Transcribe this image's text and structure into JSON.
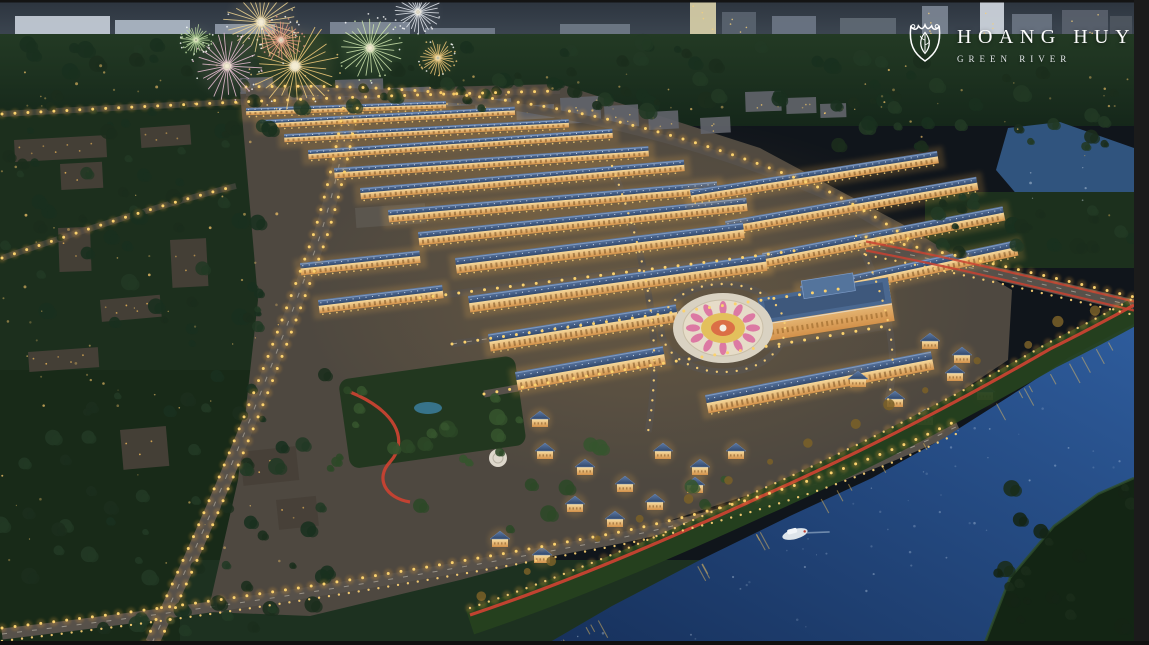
{
  "image": {
    "kind": "aerial-night-rendering",
    "subject": "riverside residential masterplan with fireworks"
  },
  "brand": {
    "name": "HOANG HUY",
    "subtitle": "GREEN RIVER",
    "icon": "shield-leaf-crest-icon",
    "text_color": "#ffffff"
  },
  "palette": {
    "sky": "#39434f",
    "sky_top": "#2c343e",
    "forest_dark": "#1b2e1c",
    "forest_deep": "#142415",
    "dev_ground": "#4e4840",
    "roof_blue": "#3c5880",
    "facade_gold": "#eec07a",
    "street_glow": "#fbd26e",
    "jogging_red": "#c84231",
    "water": "#1d4076",
    "water_light": "#2e5c9c",
    "plaza_pink": "#d9679c",
    "plaza_yellow": "#e3c05c",
    "frame_black": "#161616"
  },
  "scene": {
    "fireworks": [
      {
        "x": 295,
        "y": 66,
        "r": 44,
        "color": "#f6cf7c"
      },
      {
        "x": 261,
        "y": 22,
        "r": 36,
        "color": "#f3d894"
      },
      {
        "x": 227,
        "y": 66,
        "r": 34,
        "color": "#eec2d8"
      },
      {
        "x": 281,
        "y": 40,
        "r": 22,
        "color": "#e89a84"
      },
      {
        "x": 370,
        "y": 48,
        "r": 32,
        "color": "#cfe6ae"
      },
      {
        "x": 418,
        "y": 12,
        "r": 22,
        "color": "#e8ecf2"
      },
      {
        "x": 438,
        "y": 58,
        "r": 18,
        "color": "#f0c878"
      },
      {
        "x": 196,
        "y": 40,
        "r": 15,
        "color": "#bcd9a0"
      }
    ],
    "skyline": [
      {
        "x": 15,
        "y": 16,
        "w": 95,
        "h": 26,
        "c": "#c5cdd8"
      },
      {
        "x": 115,
        "y": 20,
        "w": 75,
        "h": 22,
        "c": "#aeb8c6"
      },
      {
        "x": 215,
        "y": 24,
        "w": 60,
        "h": 18,
        "c": "#8f99a8"
      },
      {
        "x": 330,
        "y": 22,
        "w": 80,
        "h": 20,
        "c": "#7f8998"
      },
      {
        "x": 425,
        "y": 28,
        "w": 70,
        "h": 16,
        "c": "#747e8c"
      },
      {
        "x": 560,
        "y": 24,
        "w": 70,
        "h": 18,
        "c": "#6f7987"
      },
      {
        "x": 690,
        "y": 0,
        "w": 26,
        "h": 44,
        "c": "#d8cfa8"
      },
      {
        "x": 722,
        "y": 12,
        "w": 34,
        "h": 30,
        "c": "#59636f"
      },
      {
        "x": 772,
        "y": 16,
        "w": 44,
        "h": 26,
        "c": "#6b7584"
      },
      {
        "x": 840,
        "y": 18,
        "w": 56,
        "h": 22,
        "c": "#5f6974"
      },
      {
        "x": 922,
        "y": 6,
        "w": 26,
        "h": 32,
        "c": "#7c8694"
      },
      {
        "x": 980,
        "y": 0,
        "w": 24,
        "h": 40,
        "c": "#cfd6de"
      },
      {
        "x": 1012,
        "y": 14,
        "w": 40,
        "h": 26,
        "c": "#6a7482"
      },
      {
        "x": 1062,
        "y": 10,
        "w": 46,
        "h": 28,
        "c": "#59616c"
      },
      {
        "x": 1110,
        "y": 16,
        "w": 22,
        "h": 22,
        "c": "#4e565f"
      }
    ],
    "edge_blocks": [
      {
        "x": 240,
        "y": 78,
        "w": 40,
        "h": 16,
        "r": -2
      },
      {
        "x": 288,
        "y": 86,
        "w": 34,
        "h": 14,
        "r": -2
      },
      {
        "x": 335,
        "y": 80,
        "w": 48,
        "h": 20,
        "r": -2
      },
      {
        "x": 392,
        "y": 88,
        "w": 38,
        "h": 15,
        "r": -2
      },
      {
        "x": 436,
        "y": 94,
        "w": 34,
        "h": 13,
        "r": -3
      },
      {
        "x": 475,
        "y": 100,
        "w": 36,
        "h": 13,
        "r": -3
      },
      {
        "x": 516,
        "y": 106,
        "w": 38,
        "h": 14,
        "r": -3
      },
      {
        "x": 560,
        "y": 98,
        "w": 40,
        "h": 26,
        "r": -3
      },
      {
        "x": 604,
        "y": 106,
        "w": 34,
        "h": 22,
        "r": -3
      },
      {
        "x": 648,
        "y": 112,
        "w": 30,
        "h": 18,
        "r": -3
      },
      {
        "x": 700,
        "y": 118,
        "w": 30,
        "h": 16,
        "r": -3
      },
      {
        "x": 745,
        "y": 92,
        "w": 36,
        "h": 20,
        "r": -2
      },
      {
        "x": 786,
        "y": 98,
        "w": 30,
        "h": 16,
        "r": -2
      },
      {
        "x": 820,
        "y": 104,
        "w": 26,
        "h": 14,
        "r": -2
      }
    ],
    "townhouse_rows": [
      {
        "x": 246,
        "y": 108,
        "a": -2,
        "l": 200,
        "h": 7
      },
      {
        "x": 260,
        "y": 120,
        "a": -3,
        "l": 255,
        "h": 8
      },
      {
        "x": 284,
        "y": 134,
        "a": -3,
        "l": 285,
        "h": 8
      },
      {
        "x": 308,
        "y": 150,
        "a": -4,
        "l": 305,
        "h": 9
      },
      {
        "x": 334,
        "y": 168,
        "a": -4,
        "l": 315,
        "h": 10
      },
      {
        "x": 360,
        "y": 188,
        "a": -5,
        "l": 325,
        "h": 11
      },
      {
        "x": 388,
        "y": 210,
        "a": -5,
        "l": 330,
        "h": 12
      },
      {
        "x": 418,
        "y": 232,
        "a": -6,
        "l": 330,
        "h": 13
      },
      {
        "x": 690,
        "y": 190,
        "a": -9,
        "l": 250,
        "h": 12
      },
      {
        "x": 725,
        "y": 221,
        "a": -10,
        "l": 255,
        "h": 13
      },
      {
        "x": 762,
        "y": 253,
        "a": -11,
        "l": 245,
        "h": 14
      },
      {
        "x": 800,
        "y": 286,
        "a": -12,
        "l": 220,
        "h": 15
      },
      {
        "x": 455,
        "y": 258,
        "a": -7,
        "l": 290,
        "h": 15
      },
      {
        "x": 468,
        "y": 296,
        "a": -8,
        "l": 300,
        "h": 16
      },
      {
        "x": 488,
        "y": 334,
        "a": -9,
        "l": 190,
        "h": 17
      },
      {
        "x": 515,
        "y": 372,
        "a": -10,
        "l": 150,
        "h": 18
      },
      {
        "x": 705,
        "y": 395,
        "a": -11,
        "l": 230,
        "h": 18
      },
      {
        "x": 300,
        "y": 263,
        "a": -6,
        "l": 120,
        "h": 12
      },
      {
        "x": 318,
        "y": 300,
        "a": -7,
        "l": 125,
        "h": 13
      }
    ],
    "villas": [
      {
        "x": 545,
        "y": 452
      },
      {
        "x": 585,
        "y": 468
      },
      {
        "x": 625,
        "y": 485
      },
      {
        "x": 663,
        "y": 452
      },
      {
        "x": 700,
        "y": 468
      },
      {
        "x": 575,
        "y": 505
      },
      {
        "x": 615,
        "y": 520
      },
      {
        "x": 655,
        "y": 503
      },
      {
        "x": 695,
        "y": 486
      },
      {
        "x": 736,
        "y": 452
      },
      {
        "x": 540,
        "y": 420
      },
      {
        "x": 500,
        "y": 540
      },
      {
        "x": 542,
        "y": 556
      },
      {
        "x": 858,
        "y": 380
      },
      {
        "x": 895,
        "y": 400
      },
      {
        "x": 925,
        "y": 418
      },
      {
        "x": 955,
        "y": 374
      },
      {
        "x": 985,
        "y": 393
      },
      {
        "x": 930,
        "y": 342
      },
      {
        "x": 962,
        "y": 356
      }
    ],
    "left_buildings": [
      {
        "x": 14,
        "y": 140,
        "w": 92,
        "h": 22,
        "r": -3
      },
      {
        "x": 60,
        "y": 164,
        "w": 42,
        "h": 26,
        "r": -3
      },
      {
        "x": 140,
        "y": 128,
        "w": 50,
        "h": 20,
        "r": -4
      },
      {
        "x": 58,
        "y": 228,
        "w": 32,
        "h": 44,
        "r": -2
      },
      {
        "x": 170,
        "y": 240,
        "w": 36,
        "h": 48,
        "r": -3
      },
      {
        "x": 100,
        "y": 300,
        "w": 60,
        "h": 22,
        "r": -5
      },
      {
        "x": 28,
        "y": 352,
        "w": 70,
        "h": 20,
        "r": -4
      },
      {
        "x": 120,
        "y": 430,
        "w": 46,
        "h": 40,
        "r": -5
      },
      {
        "x": 240,
        "y": 452,
        "w": 56,
        "h": 34,
        "r": -6
      },
      {
        "x": 276,
        "y": 500,
        "w": 40,
        "h": 30,
        "r": -6
      }
    ],
    "tree_zones": [
      {
        "x": 0,
        "y": 42,
        "w": 900,
        "h": 70,
        "n": 80,
        "p": 0
      },
      {
        "x": 0,
        "y": 110,
        "w": 270,
        "h": 250,
        "n": 55,
        "p": 0
      },
      {
        "x": 0,
        "y": 360,
        "w": 330,
        "h": 280,
        "n": 60,
        "p": 0
      },
      {
        "x": 830,
        "y": 56,
        "w": 300,
        "h": 92,
        "n": 30,
        "p": 0
      },
      {
        "x": 930,
        "y": 196,
        "w": 205,
        "h": 68,
        "n": 22,
        "p": 0
      },
      {
        "x": 984,
        "y": 486,
        "w": 150,
        "h": 155,
        "n": 20,
        "p": 1
      },
      {
        "x": 390,
        "y": 430,
        "w": 340,
        "h": 100,
        "n": 14,
        "p": 2
      },
      {
        "x": 330,
        "y": 378,
        "w": 190,
        "h": 95,
        "n": 16,
        "p": 2
      }
    ],
    "boat": {
      "x": 795,
      "y": 534,
      "rot": -15
    }
  }
}
